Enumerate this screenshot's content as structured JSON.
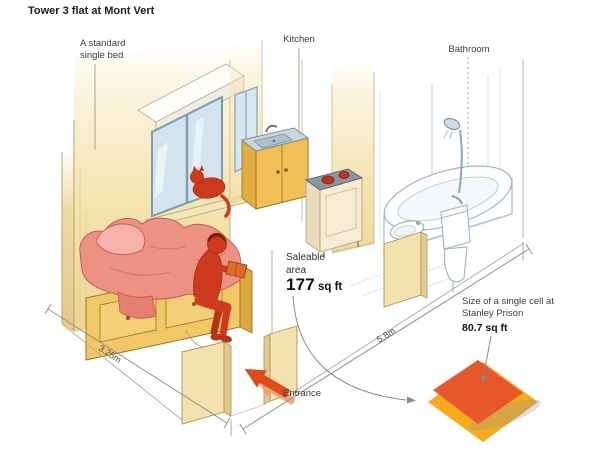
{
  "title": "Tower 3 flat at Mont Vert",
  "labels": {
    "bed": "A standard single bed",
    "kitchen": "Kitchen",
    "bathroom": "Bathroom",
    "entrance": "Entrance"
  },
  "saleable": {
    "caption": "Saleable area",
    "value": "177",
    "unit": "sq ft"
  },
  "dimensions": {
    "width": "3.25m",
    "length": "5.8m"
  },
  "comparison": {
    "caption": "Size of a single cell at Stanley Prison",
    "value": "80.7 sq ft"
  },
  "colors": {
    "wall": "#f4e2ac",
    "wood": "#f1bf55",
    "figure_red": "#ce3a1d",
    "blanket_pink": "#ec9184",
    "window_blue": "#d3e4ee",
    "entrance_arrow": "#e04b1a",
    "cell_orange": "#e8562b",
    "flat_yellow": "#f5ab1a",
    "text": "#2d2d2d"
  }
}
